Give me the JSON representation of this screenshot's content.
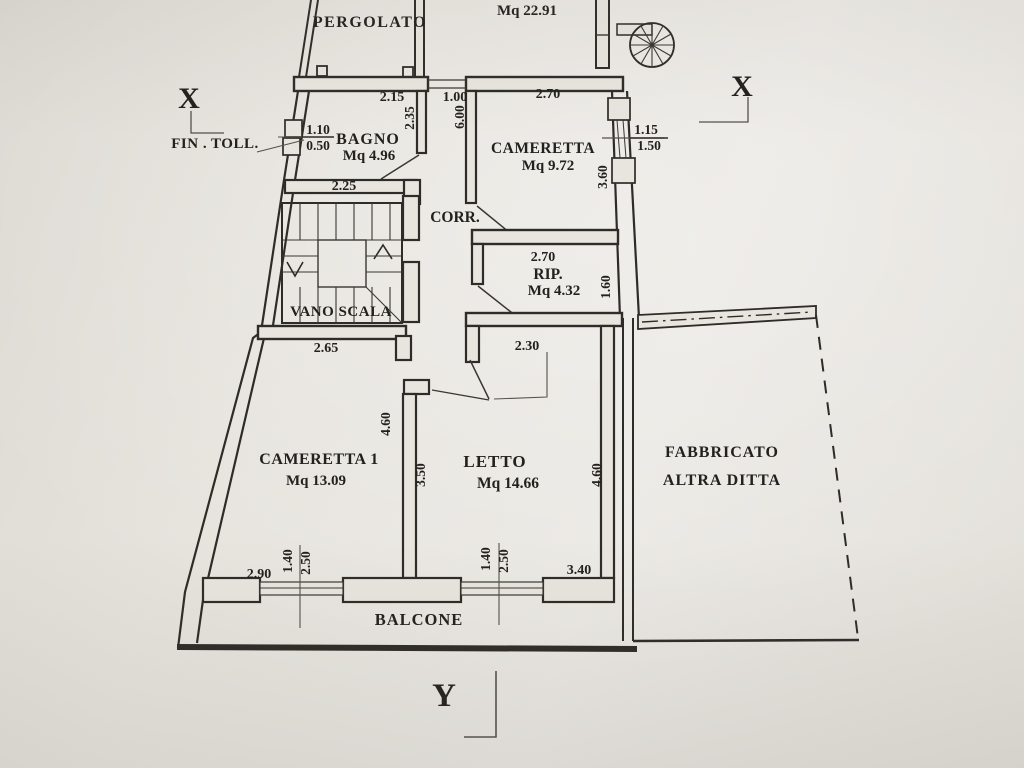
{
  "document": {
    "type": "architectural floor plan photo",
    "language": "Italian"
  },
  "section_markers": {
    "x_left": "X",
    "x_right": "X",
    "y_bottom": "Y"
  },
  "annotations": {
    "fin_toll": "FIN . TOLL.",
    "fin_toll_width": "1.10",
    "fin_toll_height": "0.50"
  },
  "rooms": {
    "pergolato": {
      "label": "PERGOLATO"
    },
    "terrace": {
      "area": "Mq 22.91"
    },
    "bagno": {
      "label": "BAGNO",
      "area": "Mq 4.96"
    },
    "cameretta": {
      "label": "CAMERETTA",
      "area": "Mq 9.72"
    },
    "corridoio": {
      "label": "CORR."
    },
    "vano_scala": {
      "label": "VANO SCALA"
    },
    "ripostiglio": {
      "label": "RIP.",
      "area": "Mq 4.32"
    },
    "cameretta1": {
      "label": "CAMERETTA 1",
      "area": "Mq 13.09"
    },
    "letto": {
      "label": "LETTO",
      "area": "Mq 14.66"
    },
    "fabbricato": {
      "line1": "FABBRICATO",
      "line2": "ALTRA DITTA"
    },
    "balcone": {
      "label": "BALCONE"
    }
  },
  "dimensions": {
    "bagno_top": "2.15",
    "corridor_top": "1.00",
    "cameretta_top": "2.70",
    "bagno_side": "2.35",
    "corridor_side": "6.00",
    "cameretta_window_w": "1.15",
    "cameretta_window_h": "1.50",
    "cameretta_side": "3.60",
    "bagno_bottom": "2.25",
    "rip_top": "2.70",
    "rip_side": "1.60",
    "cameretta1_top": "2.65",
    "letto_top": "2.30",
    "cameretta1_side": "4.60",
    "letto_side_left": "3.50",
    "letto_side_right": "4.60",
    "cameretta1_bottom": "2.90",
    "cameretta1_window_w": "1.40",
    "cameretta1_window_h": "2.50",
    "letto_window_w": "1.40",
    "letto_window_h": "2.50",
    "letto_bottom": "3.40"
  },
  "colors": {
    "paper": "#e7e4de",
    "ink": "#2e2c28"
  }
}
